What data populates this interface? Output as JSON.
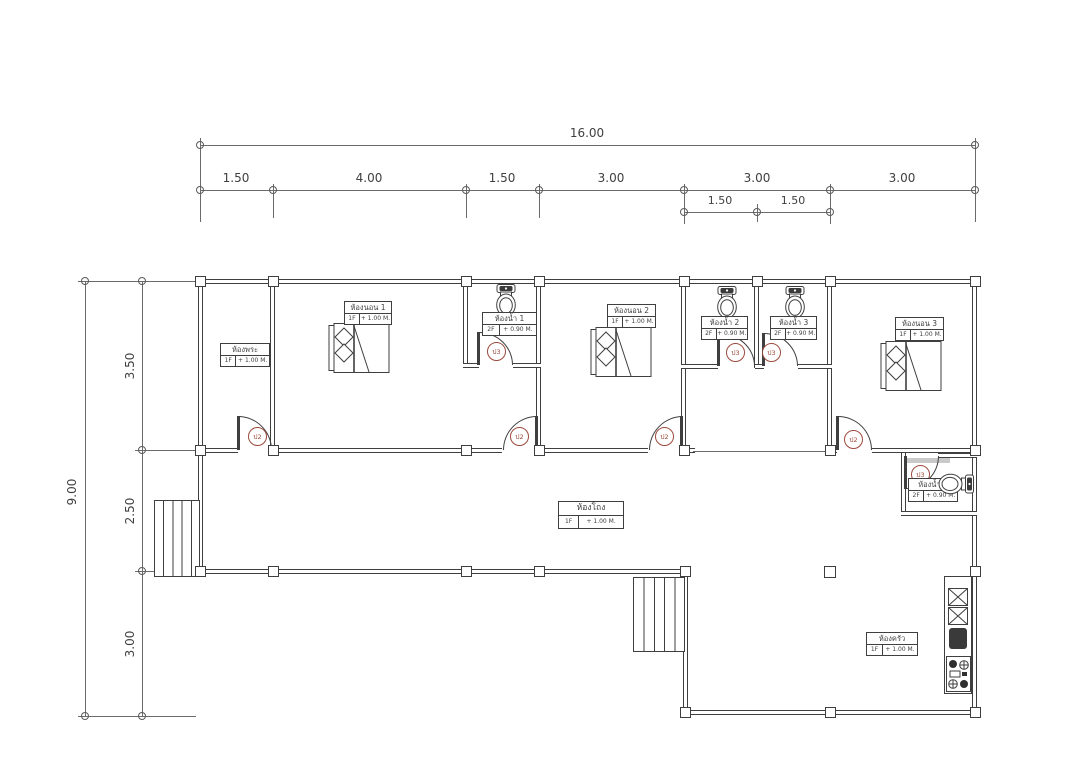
{
  "drawing": {
    "dim_top": {
      "overall": "16.00",
      "segments": [
        "1.50",
        "4.00",
        "1.50",
        "3.00",
        "3.00",
        "3.00"
      ],
      "sub_segments": [
        "1.50",
        "1.50"
      ]
    },
    "dim_left": {
      "overall": "9.00",
      "segments": [
        "3.50",
        "2.50",
        "3.00"
      ]
    },
    "rooms": [
      {
        "name": "ห้องพระ",
        "floor": "1F",
        "level": "+ 1.00 M."
      },
      {
        "name": "ห้องนอน 1",
        "floor": "1F",
        "level": "+ 1.00 M."
      },
      {
        "name": "ห้องน้ำ 1",
        "floor": "2F",
        "level": "+ 0.90 M."
      },
      {
        "name": "ห้องนอน 2",
        "floor": "1F",
        "level": "+ 1.00 M."
      },
      {
        "name": "ห้องน้ำ 2",
        "floor": "2F",
        "level": "+ 0.90 M."
      },
      {
        "name": "ห้องน้ำ 3",
        "floor": "2F",
        "level": "+ 0.90 M."
      },
      {
        "name": "ห้องนอน 3",
        "floor": "1F",
        "level": "+ 1.00 M."
      },
      {
        "name": "ห้องน้ำ 4",
        "floor": "2F",
        "level": "+ 0.90 M."
      },
      {
        "name": "ห้องโถง",
        "floor": "1F",
        "level": "+ 1.00 M."
      },
      {
        "name": "ห้องครัว",
        "floor": "1F",
        "level": "+ 1.00 M."
      }
    ],
    "door_tags": {
      "bedroom": "ป2",
      "bathroom": "ป3"
    },
    "colors": {
      "line": "#3f3f3f",
      "tag": "#9c4a3c"
    }
  }
}
